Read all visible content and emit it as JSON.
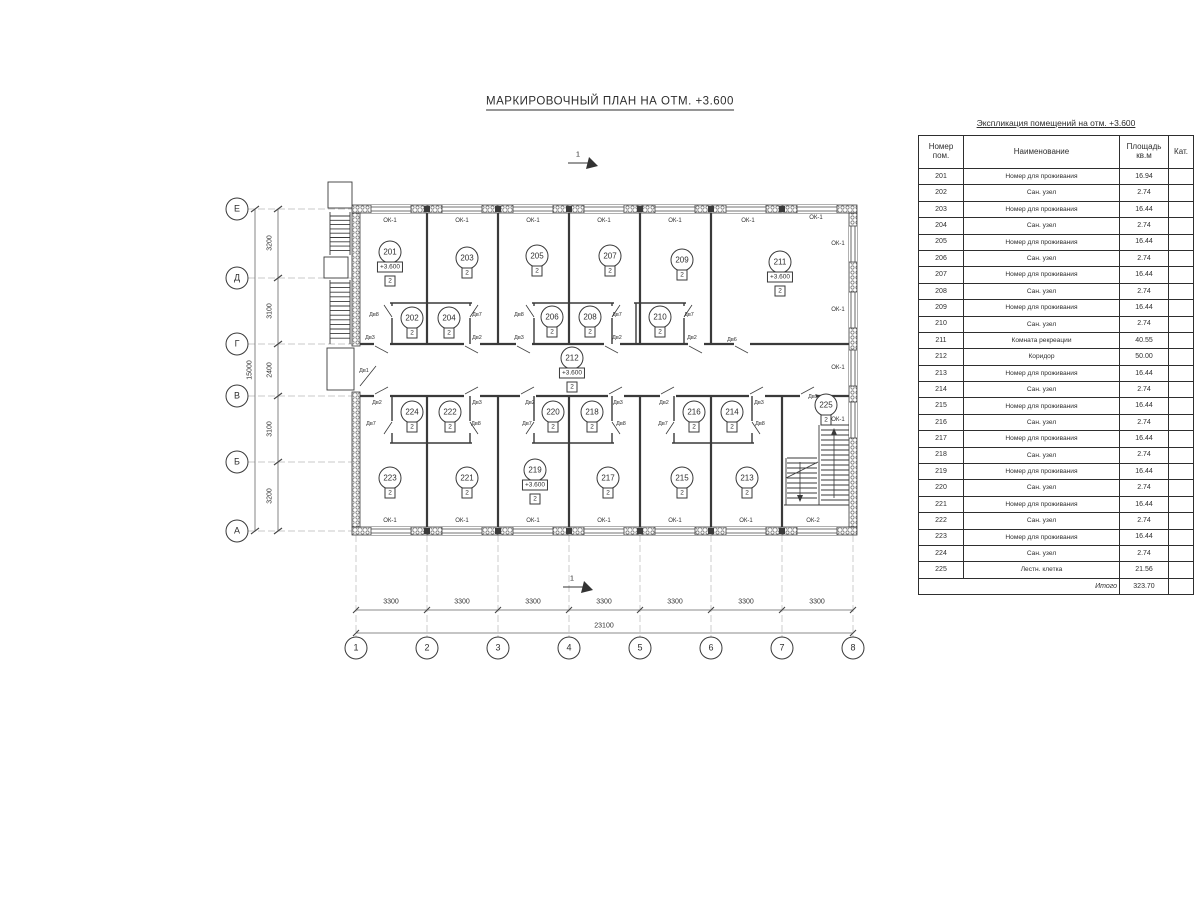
{
  "page": {
    "title": "МАРКИРОВОЧНЫЙ ПЛАН НА ОТМ. +3.600"
  },
  "explication": {
    "title": "Экспликация помещений на отм. +3.600",
    "headers": {
      "num": "Номер пом.",
      "name": "Наименование",
      "area": "Площадь кв.м",
      "cat": "Кат."
    },
    "rows": [
      {
        "num": "201",
        "name": "Номер для проживания",
        "area": "16.94",
        "cat": ""
      },
      {
        "num": "202",
        "name": "Сан. узел",
        "area": "2.74",
        "cat": ""
      },
      {
        "num": "203",
        "name": "Номер для проживания",
        "area": "16.44",
        "cat": ""
      },
      {
        "num": "204",
        "name": "Сан. узел",
        "area": "2.74",
        "cat": ""
      },
      {
        "num": "205",
        "name": "Номер для проживания",
        "area": "16.44",
        "cat": ""
      },
      {
        "num": "206",
        "name": "Сан. узел",
        "area": "2.74",
        "cat": ""
      },
      {
        "num": "207",
        "name": "Номер для проживания",
        "area": "16.44",
        "cat": ""
      },
      {
        "num": "208",
        "name": "Сан. узел",
        "area": "2.74",
        "cat": ""
      },
      {
        "num": "209",
        "name": "Номер для проживания",
        "area": "16.44",
        "cat": ""
      },
      {
        "num": "210",
        "name": "Сан. узел",
        "area": "2.74",
        "cat": ""
      },
      {
        "num": "211",
        "name": "Комната рекреации",
        "area": "40.55",
        "cat": ""
      },
      {
        "num": "212",
        "name": "Коридор",
        "area": "50.00",
        "cat": ""
      },
      {
        "num": "213",
        "name": "Номер для проживания",
        "area": "16.44",
        "cat": ""
      },
      {
        "num": "214",
        "name": "Сан. узел",
        "area": "2.74",
        "cat": ""
      },
      {
        "num": "215",
        "name": "Номер для проживания",
        "area": "16.44",
        "cat": ""
      },
      {
        "num": "216",
        "name": "Сан. узел",
        "area": "2.74",
        "cat": ""
      },
      {
        "num": "217",
        "name": "Номер для проживания",
        "area": "16.44",
        "cat": ""
      },
      {
        "num": "218",
        "name": "Сан. узел",
        "area": "2.74",
        "cat": ""
      },
      {
        "num": "219",
        "name": "Номер для проживания",
        "area": "16.44",
        "cat": ""
      },
      {
        "num": "220",
        "name": "Сан. узел",
        "area": "2.74",
        "cat": ""
      },
      {
        "num": "221",
        "name": "Номер для проживания",
        "area": "16.44",
        "cat": ""
      },
      {
        "num": "222",
        "name": "Сан. узел",
        "area": "2.74",
        "cat": ""
      },
      {
        "num": "223",
        "name": "Номер для проживания",
        "area": "16.44",
        "cat": ""
      },
      {
        "num": "224",
        "name": "Сан. узел",
        "area": "2.74",
        "cat": ""
      },
      {
        "num": "225",
        "name": "Лестн. клетка",
        "area": "21.56",
        "cat": ""
      }
    ],
    "total_label": "Итого",
    "total_value": "323.70"
  },
  "plan": {
    "rooms": [
      {
        "num": "201",
        "elevation": "+3.600",
        "category": "2"
      },
      {
        "num": "202",
        "category": "2"
      },
      {
        "num": "203",
        "category": "2"
      },
      {
        "num": "204",
        "category": "2"
      },
      {
        "num": "205",
        "category": "2"
      },
      {
        "num": "206",
        "category": "2"
      },
      {
        "num": "207",
        "category": "2"
      },
      {
        "num": "208",
        "category": "2"
      },
      {
        "num": "209",
        "category": "2"
      },
      {
        "num": "210",
        "category": "2"
      },
      {
        "num": "211",
        "elevation": "+3.600",
        "category": "2"
      },
      {
        "num": "212",
        "elevation": "+3.600",
        "category": "2"
      },
      {
        "num": "213",
        "category": "2"
      },
      {
        "num": "214",
        "category": "2"
      },
      {
        "num": "215",
        "category": "2"
      },
      {
        "num": "216",
        "category": "2"
      },
      {
        "num": "217",
        "category": "2"
      },
      {
        "num": "218",
        "category": "2"
      },
      {
        "num": "219",
        "elevation": "+3.600",
        "category": "2"
      },
      {
        "num": "220",
        "category": "2"
      },
      {
        "num": "221",
        "category": "2"
      },
      {
        "num": "222",
        "category": "2"
      },
      {
        "num": "223",
        "category": "2"
      },
      {
        "num": "224",
        "category": "2"
      },
      {
        "num": "225",
        "category": "2"
      }
    ],
    "door_labels": [
      "Дв8",
      "Дв7",
      "Дв3",
      "Дв2",
      "Дв8",
      "Дв7",
      "Дв3",
      "Дв2",
      "Дв7",
      "Дв2",
      "Дв6",
      "Дв1",
      "Дв2",
      "Дв7",
      "Дв3",
      "Дв8",
      "Дв2",
      "Дв7",
      "Дв3",
      "Дв8",
      "Дв2",
      "Дв7",
      "Дв3",
      "Дв8",
      "Дв9"
    ],
    "window_labels": [
      "ОК-1",
      "ОК-1",
      "ОК-1",
      "ОК-1",
      "ОК-1",
      "ОК-1",
      "ОК-1",
      "ОК-1",
      "ОК-1",
      "ОК-1",
      "ОК-1",
      "ОК-1",
      "ОК-1",
      "ОК-1",
      "ОК-1",
      "ОК-1",
      "ОК-1",
      "ОК-2"
    ],
    "axes": {
      "rows": [
        "Е",
        "Д",
        "Г",
        "В",
        "Б",
        "А"
      ],
      "cols": [
        "1",
        "2",
        "3",
        "4",
        "5",
        "6",
        "7",
        "8"
      ]
    },
    "dims": {
      "left": [
        "3200",
        "3100",
        "2400",
        "3100",
        "3200"
      ],
      "left_total": "15000",
      "bottom": [
        "3300",
        "3300",
        "3300",
        "3300",
        "3300",
        "3300",
        "3300"
      ],
      "bottom_total": "23100"
    },
    "section_markers": [
      "1",
      "1"
    ]
  },
  "colors": {
    "line": "#3a3a3a",
    "light_line": "#b8b8b8",
    "text": "#2e2e2e"
  }
}
